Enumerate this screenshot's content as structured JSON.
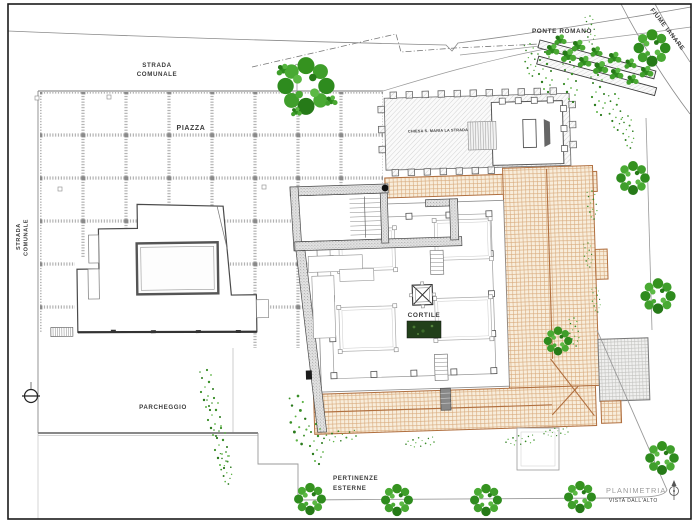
{
  "labels": {
    "strada_top_1": "STRADA",
    "strada_top_2": "COMUNALE",
    "strada_left_1": "STRADA",
    "strada_left_2": "COMUNALE",
    "piazza": "PIAZZA",
    "ponte_romano": "PONTE ROMANO",
    "fiume": "FIUME IANARE",
    "chiesa": "CHIESA S. MARIA LA STRADA",
    "cortile": "CORTILE",
    "parcheggio": "PARCHEGGIO",
    "pertinenze_1": "PERTINENZE",
    "pertinenze_2": "ESTERNE",
    "planimetria": "PLANIMETRIA",
    "vista": "VISTA DALL'ALTO"
  },
  "colors": {
    "roof_tan_line": "#d8aa7c",
    "roof_tan_border": "#b06f3f",
    "tree_green": "#3a9427",
    "hatch_gray": "#c6c6c6",
    "wall_stipple": "#969696",
    "caption_gray": "#9b9b9b",
    "line_dark": "#3c3c3c"
  }
}
